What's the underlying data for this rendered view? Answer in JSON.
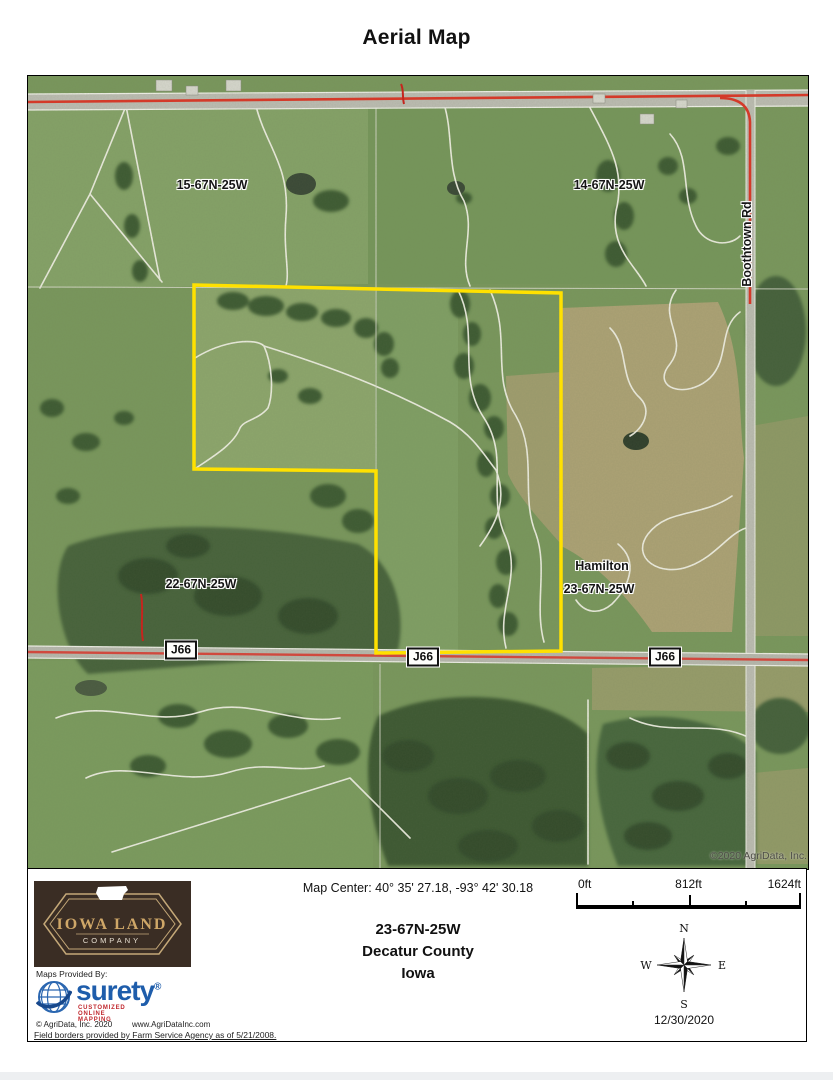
{
  "title": "Aerial Map",
  "map": {
    "section_nw": "15-67N-25W",
    "section_ne": "14-67N-25W",
    "section_sw": "22-67N-25W",
    "section_se": "23-67N-25W",
    "town": "Hamilton",
    "road_vertical": "Boothtown Rd",
    "shields": [
      "J66",
      "J66",
      "J66"
    ],
    "copyright": "©2020 AgriData, Inc."
  },
  "panel": {
    "map_center": "Map Center: 40° 35' 27.18,  -93° 42' 30.18",
    "scale_start": "0ft",
    "scale_mid": "812ft",
    "scale_end": "1624ft",
    "township": "23-67N-25W",
    "county": "Decatur County",
    "state": "Iowa",
    "date": "12/30/2020",
    "compass_n": "N",
    "compass_e": "E",
    "compass_s": "S",
    "compass_w": "W"
  },
  "branding": {
    "logo_line1": "IOWA LAND",
    "logo_line2": "COMPANY",
    "provided_by": "Maps Provided By:",
    "surety_name": "surety",
    "surety_reg": "®",
    "surety_tagline": "CUSTOMIZED ONLINE MAPPING",
    "agridata_copyright": "© AgriData, Inc. 2020",
    "agridata_url": "www.AgriDataInc.com"
  },
  "footer_note": "Field borders provided by Farm Service Agency as of 5/21/2008.",
  "colors": {
    "boundary_yellow": "#ffe100",
    "highway_red": "#dc3526",
    "surety_blue": "#1e5dab",
    "tagline_red": "#c0262c",
    "logo_brown": "#3a2d24",
    "logo_gold": "#cfa768",
    "field_green": "#79975c",
    "crop_tan": "#b2a378"
  }
}
